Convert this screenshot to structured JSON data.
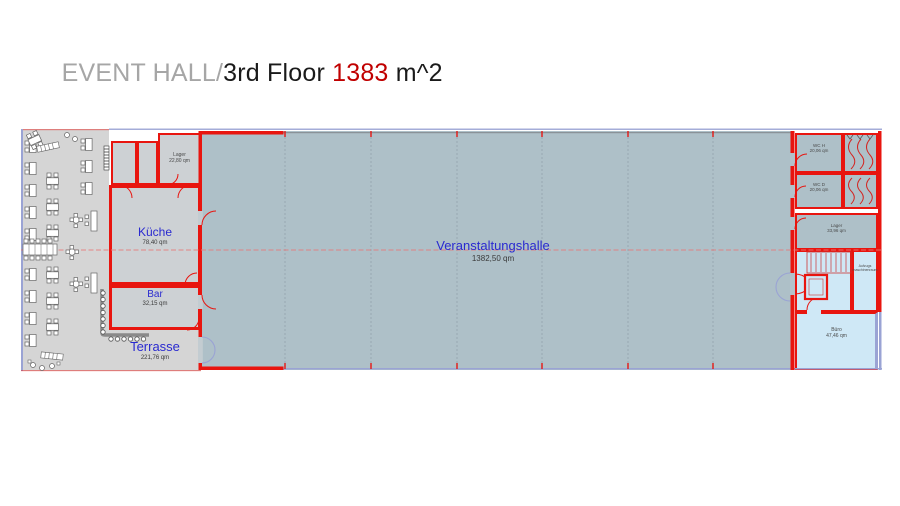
{
  "title": {
    "project": "EVENT HALL",
    "separator": "/",
    "floor": "3rd Floor ",
    "area_value": "1383",
    "area_unit": " m^2"
  },
  "colors": {
    "title_gray": "#a6a6a6",
    "title_red": "#c00000",
    "wall_red": "#e8150f",
    "hall_fill": "#aec0c8",
    "terrace_fill": "#d5d5d5",
    "room_fill": "#cdd1d4",
    "blue_room_fill": "#cfe8f6",
    "label_blue": "#2a2ad0",
    "lavender_accent": "#9aa3d4"
  },
  "plan": {
    "rooms": {
      "hall": {
        "name": "Veranstaltungshalle",
        "area": "1382,50 qm"
      },
      "kitchen": {
        "name": "Küche",
        "area": "78,40 qm"
      },
      "bar": {
        "name": "Bar",
        "area": "32,15 qm"
      },
      "terrace": {
        "name": "Terrasse",
        "area": "221,76 qm"
      },
      "storage_left": {
        "name": "Lager",
        "area": "22,80 qm"
      },
      "wc_h": {
        "name": "WC H",
        "area": "20,06 qm"
      },
      "wc_d": {
        "name": "WC D",
        "area": "20,06 qm"
      },
      "storage_right": {
        "name": "Lager",
        "area": "33,96 qm"
      },
      "elevator_machine_room": {
        "name_line1": "Aufzugs",
        "name_line2": "maschinenraum"
      },
      "office": {
        "name": "Büro",
        "area": "47,46 qm"
      }
    }
  }
}
